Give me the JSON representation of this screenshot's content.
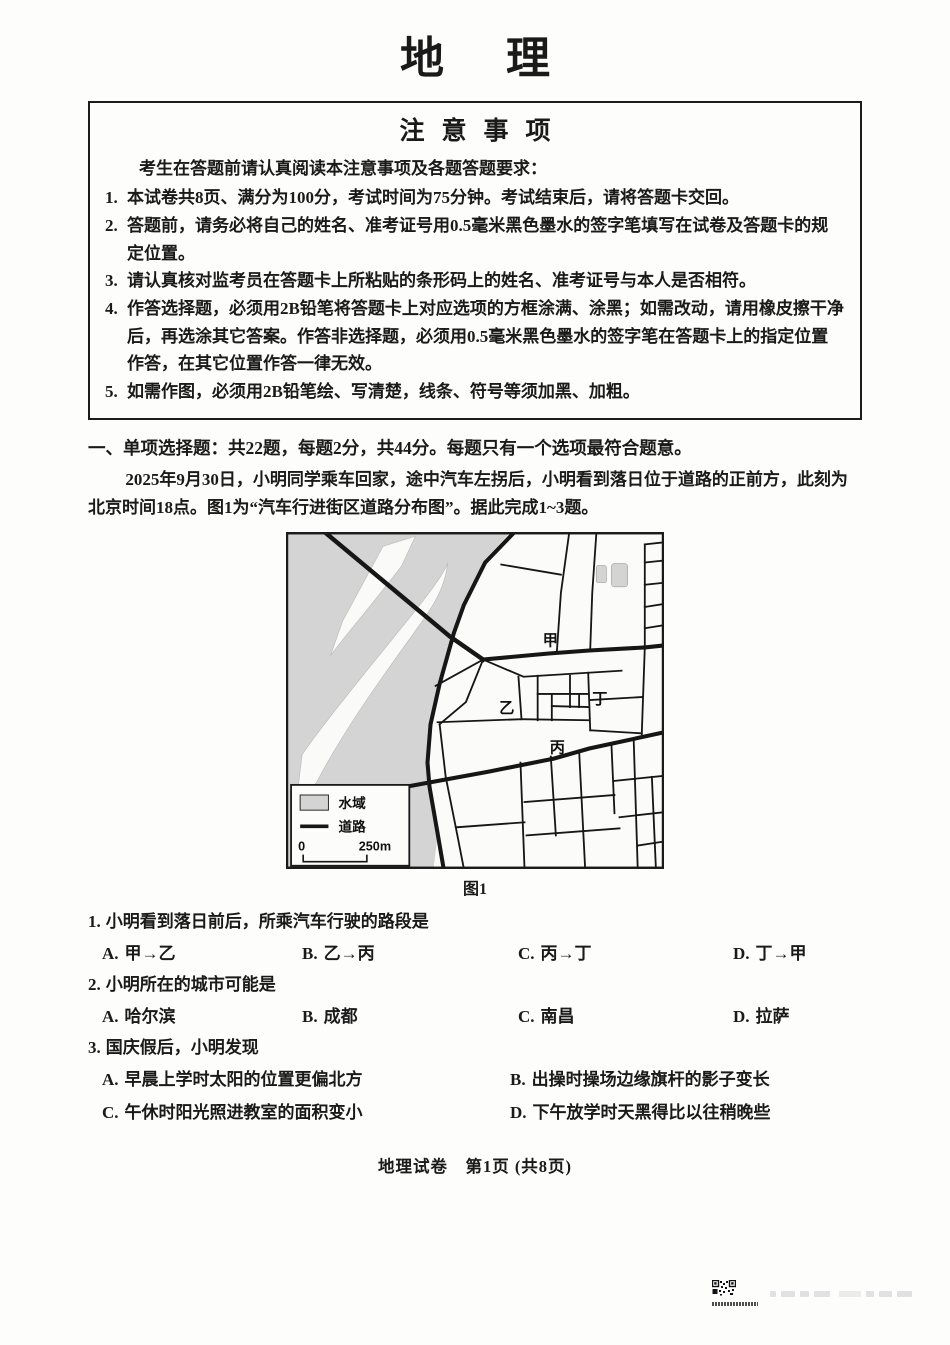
{
  "page": {
    "title": "地理"
  },
  "notice": {
    "header": "注意事项",
    "intro": "考生在答题前请认真阅读本注意事项及各题答题要求：",
    "items": [
      {
        "num": "1.",
        "text": "本试卷共8页、满分为100分，考试时间为75分钟。考试结束后，请将答题卡交回。"
      },
      {
        "num": "2.",
        "text": "答题前，请务必将自己的姓名、准考证号用0.5毫米黑色墨水的签字笔填写在试卷及答题卡的规定位置。"
      },
      {
        "num": "3.",
        "text": "请认真核对监考员在答题卡上所粘贴的条形码上的姓名、准考证号与本人是否相符。"
      },
      {
        "num": "4.",
        "text": "作答选择题，必须用2B铅笔将答题卡上对应选项的方框涂满、涂黑；如需改动，请用橡皮擦干净后，再选涂其它答案。作答非选择题，必须用0.5毫米黑色墨水的签字笔在答题卡上的指定位置作答，在其它位置作答一律无效。"
      },
      {
        "num": "5.",
        "text": "如需作图，必须用2B铅笔绘、写清楚，线条、符号等须加黑、加粗。"
      }
    ]
  },
  "section": {
    "heading": "一、单项选择题：共22题，每题2分，共44分。每题只有一个选项最符合题意。"
  },
  "passage": {
    "text": "2025年9月30日，小明同学乘车回家，途中汽车左拐后，小明看到落日位于道路的正前方，此刻为北京时间18点。图1为“汽车行进街区道路分布图”。据此完成1~3题。"
  },
  "figure": {
    "caption": "图1",
    "map": {
      "labels": {
        "jia": "甲",
        "yi": "乙",
        "bing": "丙",
        "ding": "丁"
      },
      "legend": {
        "water_label": "水域",
        "road_label": "道路",
        "scale_zero": "0",
        "scale_label": "250m"
      },
      "colors": {
        "water": "#d4d4d4",
        "road": "#161616"
      }
    }
  },
  "questions": [
    {
      "num": "1.",
      "stem": "小明看到落日前后，所乘汽车行驶的路段是",
      "options": [
        {
          "label": "A.",
          "text": "甲→乙"
        },
        {
          "label": "B.",
          "text": "乙→丙"
        },
        {
          "label": "C.",
          "text": "丙→丁"
        },
        {
          "label": "D.",
          "text": "丁→甲"
        }
      ]
    },
    {
      "num": "2.",
      "stem": "小明所在的城市可能是",
      "options": [
        {
          "label": "A.",
          "text": "哈尔滨"
        },
        {
          "label": "B.",
          "text": "成都"
        },
        {
          "label": "C.",
          "text": "南昌"
        },
        {
          "label": "D.",
          "text": "拉萨"
        }
      ]
    },
    {
      "num": "3.",
      "stem": "国庆假后，小明发现",
      "options": [
        {
          "label": "A.",
          "text": "早晨上学时太阳的位置更偏北方"
        },
        {
          "label": "B.",
          "text": "出操时操场边缘旗杆的影子变长"
        },
        {
          "label": "C.",
          "text": "午休时阳光照进教室的面积变小"
        },
        {
          "label": "D.",
          "text": "下午放学时天黑得比以往稍晚些"
        }
      ]
    }
  ],
  "footer": {
    "text": "地理试卷　第1页 (共8页)"
  }
}
